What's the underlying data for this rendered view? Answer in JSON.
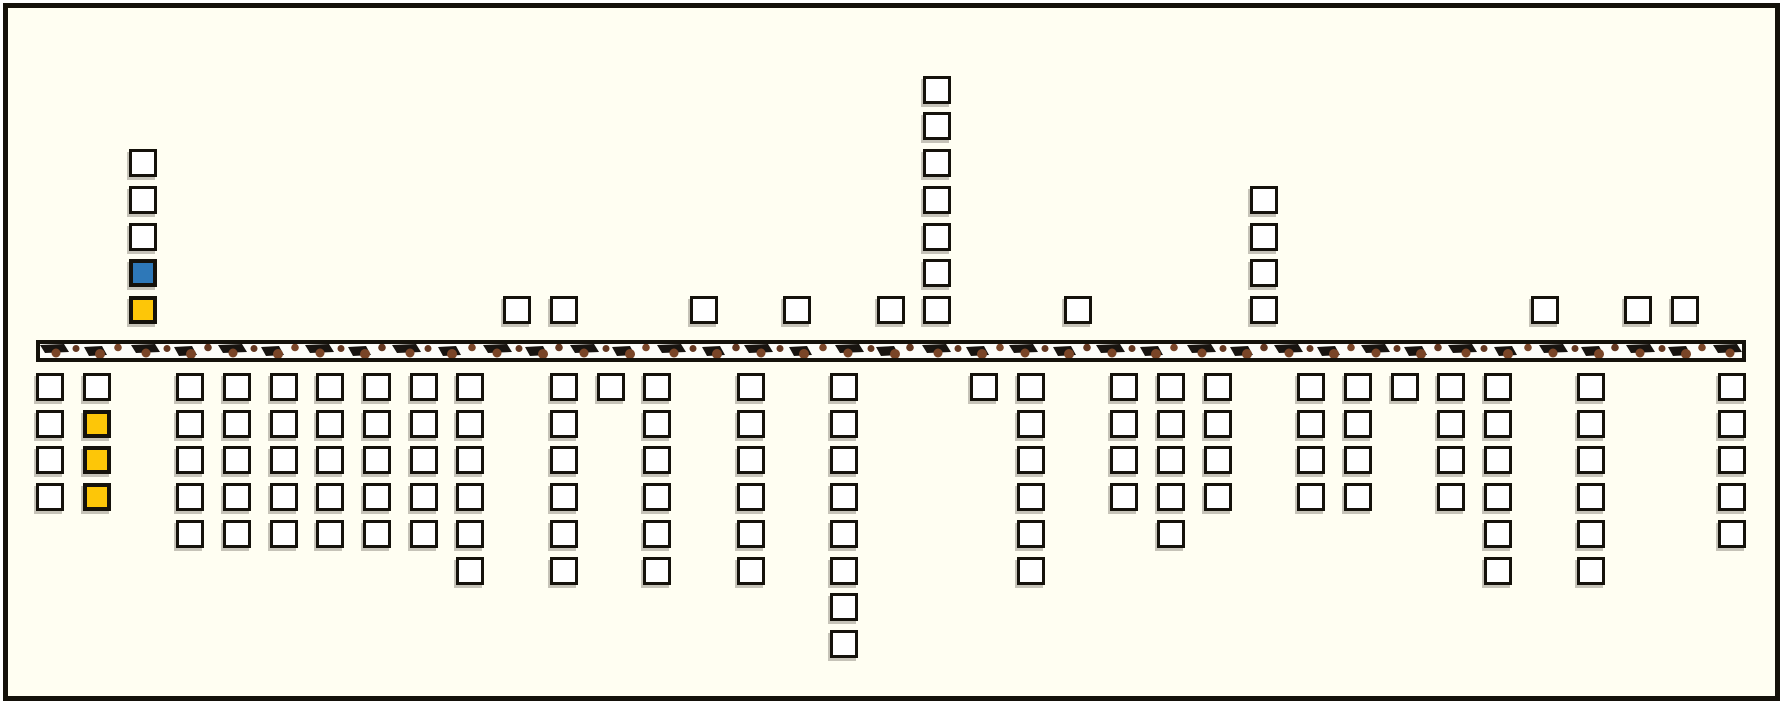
{
  "scene": {
    "description": "game-level strip: stacks of crate blocks above and below a textured ground band",
    "background_color": "#fffef2",
    "outline_color": "#15120b"
  },
  "palette": {
    "w": "#ffffff",
    "b": "#2e78b8",
    "y": "#fdc608",
    "white_block": "#ffffff",
    "blue_block": "#2e78b8",
    "yellow_block": "#fdc608",
    "ground_fill": "#fcfcf8",
    "ground_dash": "#181410",
    "ground_dot_brown": "#7a4527",
    "ground_dot_dark": "#63361f",
    "shadow": "rgba(128,124,112,0.45)"
  },
  "board": {
    "num_columns": 37,
    "columns": [
      {
        "i": 0,
        "above": [],
        "below": [
          "w",
          "w",
          "w",
          "w"
        ]
      },
      {
        "i": 1,
        "above": [],
        "below": [
          "w",
          "y",
          "y",
          "y"
        ]
      },
      {
        "i": 2,
        "above": [
          "w",
          "w",
          "w",
          "b",
          "y"
        ],
        "below": []
      },
      {
        "i": 3,
        "above": [],
        "below": [
          "w",
          "w",
          "w",
          "w",
          "w"
        ]
      },
      {
        "i": 4,
        "above": [],
        "below": [
          "w",
          "w",
          "w",
          "w",
          "w"
        ]
      },
      {
        "i": 5,
        "above": [],
        "below": [
          "w",
          "w",
          "w",
          "w",
          "w"
        ]
      },
      {
        "i": 6,
        "above": [],
        "below": [
          "w",
          "w",
          "w",
          "w",
          "w"
        ]
      },
      {
        "i": 7,
        "above": [],
        "below": [
          "w",
          "w",
          "w",
          "w",
          "w"
        ]
      },
      {
        "i": 8,
        "above": [],
        "below": [
          "w",
          "w",
          "w",
          "w",
          "w"
        ]
      },
      {
        "i": 9,
        "above": [],
        "below": [
          "w",
          "w",
          "w",
          "w",
          "w",
          "w"
        ]
      },
      {
        "i": 10,
        "above": [
          "w"
        ],
        "below": []
      },
      {
        "i": 11,
        "above": [
          "w"
        ],
        "below": [
          "w",
          "w",
          "w",
          "w",
          "w",
          "w"
        ]
      },
      {
        "i": 12,
        "above": [],
        "below": [
          "w"
        ]
      },
      {
        "i": 13,
        "above": [],
        "below": [
          "w",
          "w",
          "w",
          "w",
          "w",
          "w"
        ]
      },
      {
        "i": 14,
        "above": [
          "w"
        ],
        "below": []
      },
      {
        "i": 15,
        "above": [],
        "below": [
          "w",
          "w",
          "w",
          "w",
          "w",
          "w"
        ]
      },
      {
        "i": 16,
        "above": [
          "w"
        ],
        "below": []
      },
      {
        "i": 17,
        "above": [],
        "below": [
          "w",
          "w",
          "w",
          "w",
          "w",
          "w",
          "w",
          "w"
        ]
      },
      {
        "i": 18,
        "above": [
          "w"
        ],
        "below": []
      },
      {
        "i": 19,
        "above": [
          "w",
          "w",
          "w",
          "w",
          "w",
          "w",
          "w"
        ],
        "below": []
      },
      {
        "i": 20,
        "above": [],
        "below": [
          "w"
        ]
      },
      {
        "i": 21,
        "above": [],
        "below": [
          "w",
          "w",
          "w",
          "w",
          "w",
          "w"
        ]
      },
      {
        "i": 22,
        "above": [
          "w"
        ],
        "below": []
      },
      {
        "i": 23,
        "above": [],
        "below": [
          "w",
          "w",
          "w",
          "w"
        ]
      },
      {
        "i": 24,
        "above": [],
        "below": [
          "w",
          "w",
          "w",
          "w",
          "w"
        ]
      },
      {
        "i": 25,
        "above": [],
        "below": [
          "w",
          "w",
          "w",
          "w"
        ]
      },
      {
        "i": 26,
        "above": [
          "w",
          "w",
          "w",
          "w"
        ],
        "below": []
      },
      {
        "i": 27,
        "above": [],
        "below": [
          "w",
          "w",
          "w",
          "w"
        ]
      },
      {
        "i": 28,
        "above": [],
        "below": [
          "w",
          "w",
          "w",
          "w"
        ]
      },
      {
        "i": 29,
        "above": [],
        "below": [
          "w"
        ]
      },
      {
        "i": 30,
        "above": [],
        "below": [
          "w",
          "w",
          "w",
          "w"
        ]
      },
      {
        "i": 31,
        "above": [],
        "below": [
          "w",
          "w",
          "w",
          "w",
          "w",
          "w"
        ]
      },
      {
        "i": 32,
        "above": [
          "w"
        ],
        "below": []
      },
      {
        "i": 33,
        "above": [],
        "below": [
          "w",
          "w",
          "w",
          "w",
          "w",
          "w"
        ]
      },
      {
        "i": 34,
        "above": [
          "w"
        ],
        "below": []
      },
      {
        "i": 35,
        "above": [
          "w"
        ],
        "below": []
      },
      {
        "i": 36,
        "above": [],
        "below": [
          "w",
          "w",
          "w",
          "w",
          "w"
        ]
      }
    ]
  }
}
